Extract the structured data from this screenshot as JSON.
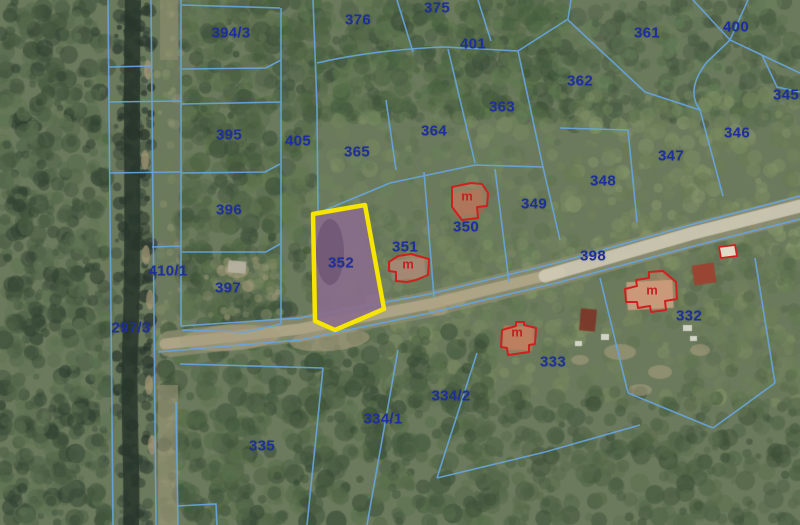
{
  "map": {
    "title": "cadastral-aerial-map",
    "highlighted_parcel": "352",
    "colors": {
      "parcel_label": "#1d2e9e",
      "boundary_line": "#67a4dc",
      "building_outline": "#cf2020",
      "building_label": "#c32222",
      "highlight_outline": "#f6e500",
      "highlight_fill": "#8a6d8d"
    },
    "parcels": [
      {
        "id": "394/3",
        "x": 231,
        "y": 33
      },
      {
        "id": "376",
        "x": 358,
        "y": 20
      },
      {
        "id": "375",
        "x": 437,
        "y": 8
      },
      {
        "id": "401",
        "x": 473,
        "y": 44
      },
      {
        "id": "361",
        "x": 647,
        "y": 33
      },
      {
        "id": "400",
        "x": 736,
        "y": 27
      },
      {
        "id": "345",
        "x": 786,
        "y": 95
      },
      {
        "id": "346",
        "x": 737,
        "y": 133
      },
      {
        "id": "362",
        "x": 580,
        "y": 81
      },
      {
        "id": "363",
        "x": 502,
        "y": 107
      },
      {
        "id": "364",
        "x": 434,
        "y": 131
      },
      {
        "id": "365",
        "x": 357,
        "y": 152
      },
      {
        "id": "405",
        "x": 298,
        "y": 141
      },
      {
        "id": "395",
        "x": 229,
        "y": 135
      },
      {
        "id": "396",
        "x": 229,
        "y": 210
      },
      {
        "id": "410/1",
        "x": 168,
        "y": 271
      },
      {
        "id": "397",
        "x": 228,
        "y": 288
      },
      {
        "id": "297/3",
        "x": 131,
        "y": 328
      },
      {
        "id": "352",
        "x": 341,
        "y": 263
      },
      {
        "id": "351",
        "x": 405,
        "y": 247
      },
      {
        "id": "350",
        "x": 466,
        "y": 227
      },
      {
        "id": "349",
        "x": 534,
        "y": 204
      },
      {
        "id": "348",
        "x": 603,
        "y": 181
      },
      {
        "id": "347",
        "x": 671,
        "y": 156
      },
      {
        "id": "398",
        "x": 593,
        "y": 256
      },
      {
        "id": "332",
        "x": 689,
        "y": 316
      },
      {
        "id": "333",
        "x": 553,
        "y": 362
      },
      {
        "id": "334/2",
        "x": 451,
        "y": 396
      },
      {
        "id": "334/1",
        "x": 383,
        "y": 419
      },
      {
        "id": "335",
        "x": 262,
        "y": 446
      }
    ],
    "buildings": [
      {
        "parcel": "350",
        "label": "m",
        "x": 467,
        "y": 196
      },
      {
        "parcel": "351",
        "label": "m",
        "x": 408,
        "y": 264
      },
      {
        "parcel": "332",
        "label": "m",
        "x": 652,
        "y": 290
      },
      {
        "parcel": "333",
        "label": "m",
        "x": 517,
        "y": 332
      }
    ]
  }
}
